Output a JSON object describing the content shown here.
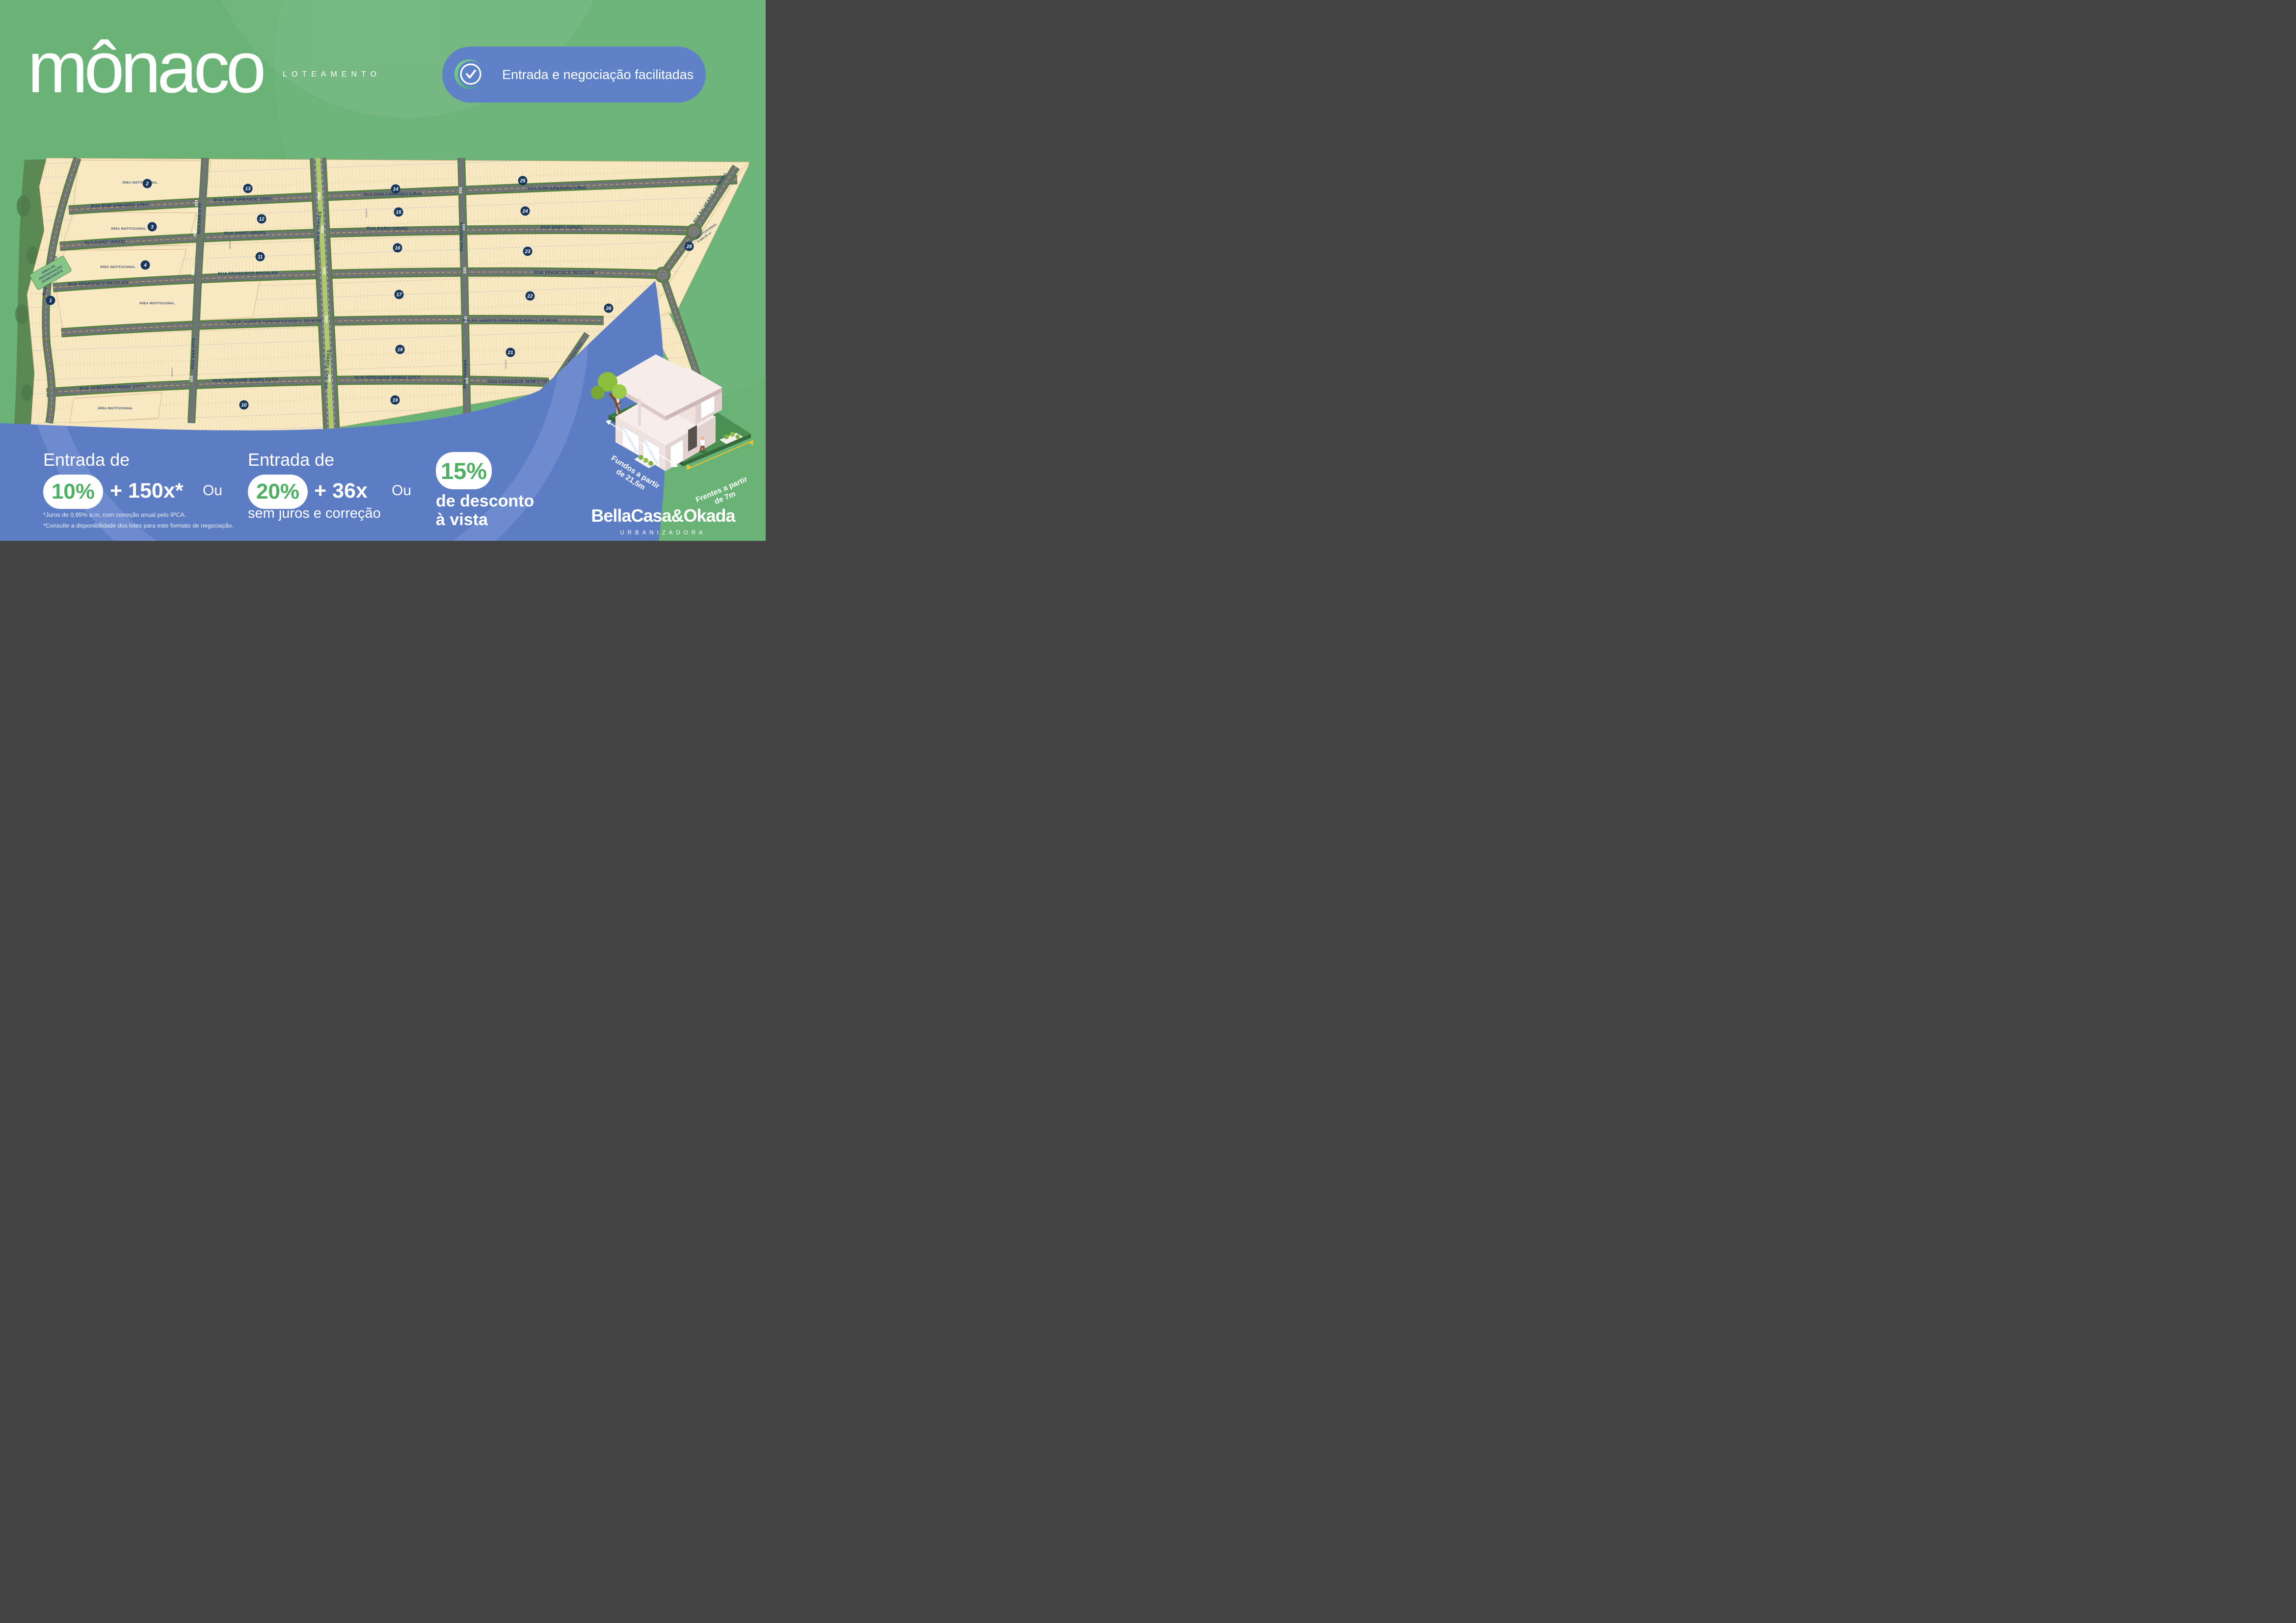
{
  "brand": {
    "logo_text": "mônaco",
    "logo_subtitle": "LOTEAMENTO"
  },
  "badge": {
    "label": "Entrada e negociação facilitadas",
    "icon": "check-circle-icon",
    "background_color": "#5F81C8"
  },
  "map": {
    "streets": {
      "dom_armando": "RUA DOM ARMANDO CÍRIO",
      "darci": "RUA DARCI ISRAEL",
      "maculan": "RUA FRANCISCO MACULAN",
      "drumond": "RUA DR. ALBERTO FERNANDO BARDDAL DRUMOND",
      "zotti": "RUA VEREADOR IRINEU ZOTTI",
      "santa_monica": "RUA SANTA MÔNICA",
      "san_vito": "RUA SAN VITO",
      "torres": "AV. DAS TORRES",
      "panama": "RUA PANAMÁ",
      "balneario": "RUA BALNEÁRIO CAMBORIÚ",
      "antonio": "RUA ANTÔNIO PEXE"
    },
    "areas": {
      "institutional": "ÁREA INSTITUCIONAL",
      "institutional_28": "9.689,85 m²",
      "preservation_l1": "ÁREA DE",
      "preservation_l2": "PRESERVAÇÃO",
      "preservation_l3": "PERMANENTE"
    },
    "quadras": [
      "1",
      "2",
      "3",
      "4",
      "10",
      "11",
      "12",
      "13",
      "14",
      "15",
      "16",
      "17",
      "18",
      "19",
      "21",
      "22",
      "23",
      "24",
      "25",
      "26",
      "27",
      "28"
    ],
    "typical_lot_areas": [
      "150,50 m²",
      "151,88 m²",
      "192,50 m²",
      "150,00 m²",
      "202,50 m²",
      "215,00 m²",
      "225,50 m²",
      "239,92 m²",
      "249,77 m²",
      "263,15 m²",
      "275,74 m²",
      "319,28 m²",
      "329,54 m²",
      "348,38 m²",
      "492,94 m²"
    ],
    "typical_lot_dims": [
      "7,00 m",
      "7,50 m",
      "8,00 m",
      "20,25 m",
      "21,50 m",
      "27,50 m"
    ],
    "colors": {
      "lot_fill": "#F8E9C3",
      "road": "#6F7478",
      "preservation": "#5B8954",
      "median": "#AFCA6B",
      "navy": "#17365D"
    }
  },
  "offers": [
    {
      "heading": "Entrada de",
      "pill": "10%",
      "installments": "+ 150x*",
      "connector": "Ou"
    },
    {
      "heading": "Entrada de",
      "pill": "20%",
      "installments": "+ 36x",
      "connector": "Ou",
      "note": "sem juros e correção"
    },
    {
      "pill": "15%",
      "line1": "de desconto",
      "line2": "à vista"
    }
  ],
  "disclaimer": [
    "*Juros de 0,95% a.m, com correção anual pelo IPCA.",
    "*Consulte a disponibilidade dos lotes para este formato de negociação."
  ],
  "lot_info": {
    "fundos_l1": "Fundos a partir",
    "fundos_l2": "de 21,5m",
    "frentes_l1": "Frentes a partir",
    "frentes_l2": "de 7m"
  },
  "developer": {
    "name": "BellaCasa&Okada",
    "subtitle": "URBANIZADORA"
  }
}
